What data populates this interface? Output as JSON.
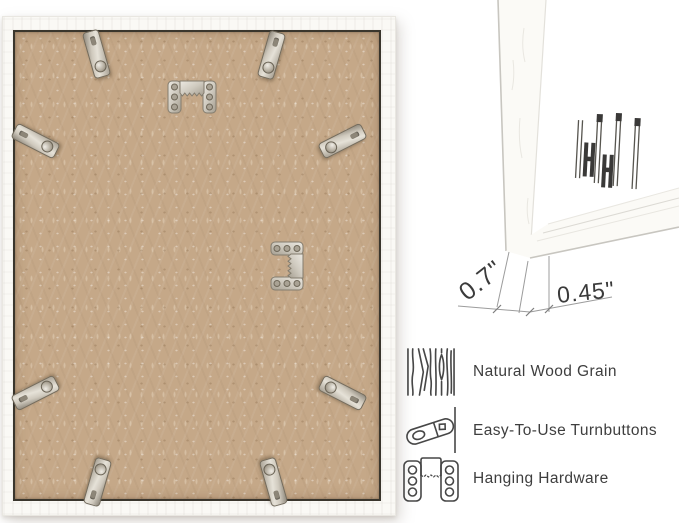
{
  "back_view": {
    "frame_color": "#faf9f5",
    "backing_color": "#c5a888",
    "dark_trim_color": "#3a362d",
    "turnbutton_count": 8,
    "hanger_count": 2
  },
  "corner_view": {
    "depth_label": "0.7\"",
    "face_label": "0.45\""
  },
  "features": [
    {
      "icon": "wood-grain-icon",
      "label": "Natural Wood Grain"
    },
    {
      "icon": "turnbutton-icon",
      "label": "Easy-To-Use Turnbuttons"
    },
    {
      "icon": "hanging-hardware-icon",
      "label": "Hanging Hardware"
    }
  ]
}
